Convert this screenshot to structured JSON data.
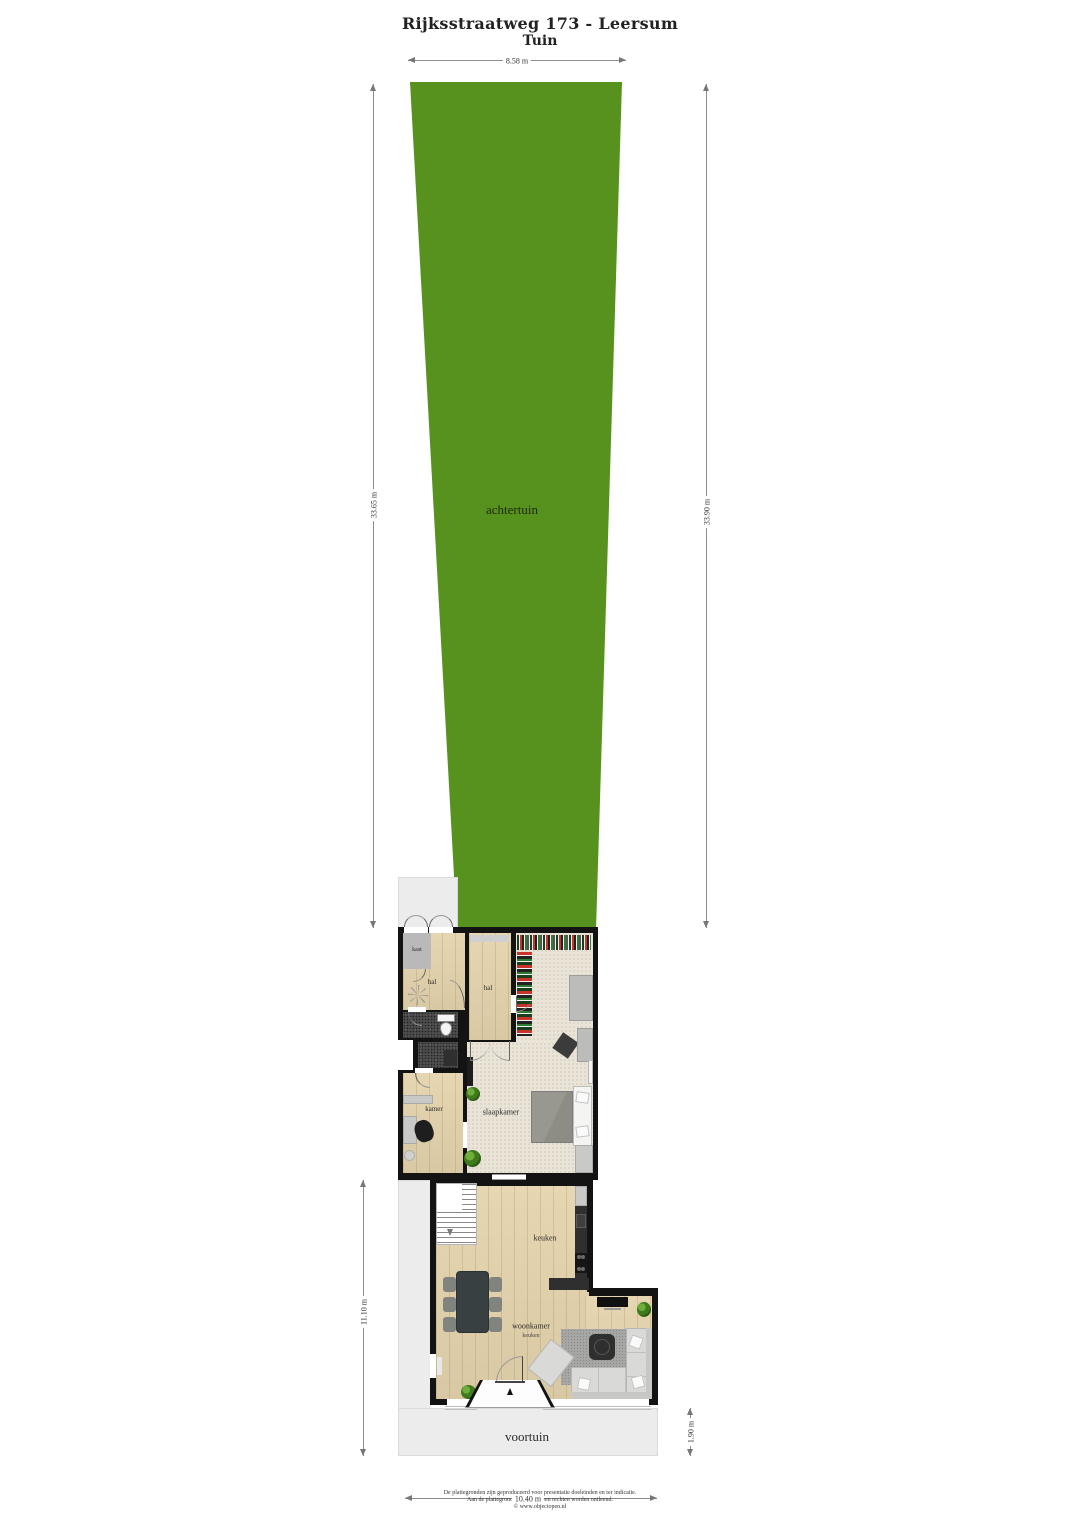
{
  "title": {
    "line1": "Rijksstraatweg 173 - Leersum",
    "line2": "Tuin"
  },
  "dimensions": {
    "garden_width_top": "8.58 m",
    "garden_length_left": "33.65 m",
    "garden_length_right": "33.90 m",
    "plot_depth_lower_left": "11.10 m",
    "house_width_bottom": "10.40 m",
    "front_garden_depth_right": "1.90 m"
  },
  "rooms": {
    "achtertuin": "achtertuin",
    "voortuin": "voortuin",
    "kast": "kast",
    "hal_left": "hal",
    "hal_right": "hal",
    "kamer": "kamer",
    "slaapkamer": "slaapkamer",
    "keuken": "keuken",
    "woonkamer": "woonkamer",
    "woonkamer_sub": "keuken"
  },
  "footer": {
    "line1": "De plattegronden zijn geproduceerd voor presentatie doeleinden en ter indicatie.",
    "line2": "Aan de plattegronden kunnen geen rechten worden ontleend.",
    "line3": "© www.objectopen.nl"
  },
  "colors": {
    "garden_green": "#58921e",
    "wall_black": "#131313",
    "wood_floor": "#e4d3ac",
    "carpet_beige": "#e9e4d7",
    "tile_dark": "#4d4d4d",
    "paving_gray": "#ececec"
  },
  "icons": {
    "ceiling_light": "ceiling-light",
    "toilet": "toilet",
    "sink": "sink",
    "bed": "bed",
    "desk_chair": "desk-chair",
    "dining_table": "dining-table",
    "sofa": "sofa",
    "tv": "tv",
    "stairs": "stairs",
    "plant": "plant",
    "clothes_rack": "clothes-rack",
    "entrance_arrow": "entrance-arrow"
  }
}
